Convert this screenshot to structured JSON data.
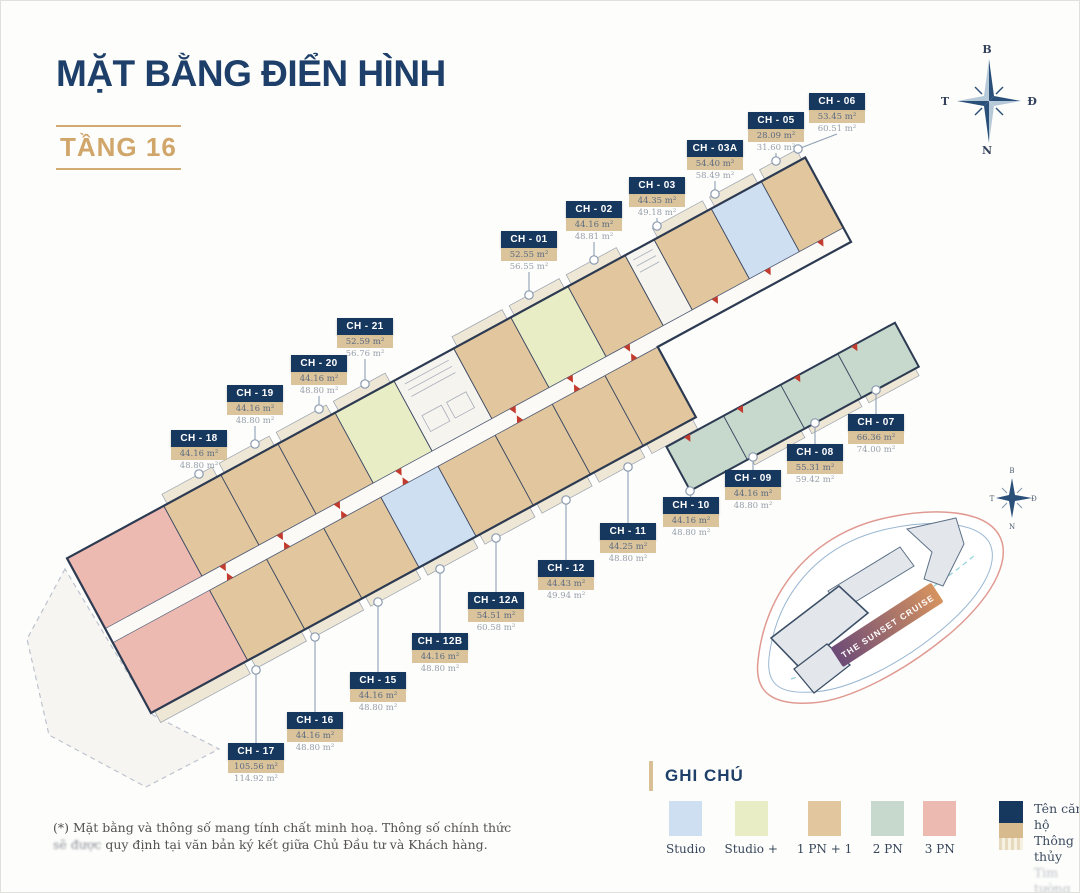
{
  "title": {
    "heading": "MẶT BẰNG ĐIỂN HÌNH",
    "floor": "TẦNG 16"
  },
  "units": [
    {
      "id": "ch-01",
      "label": "CH - 01",
      "area_net": "52.55 m²",
      "area_gross": "56.55 m²",
      "x": 500,
      "y": 230,
      "ax": 528,
      "ay": 294,
      "dir": "down"
    },
    {
      "id": "ch-02",
      "label": "CH - 02",
      "area_net": "44.16 m²",
      "area_gross": "48.81 m²",
      "x": 565,
      "y": 200,
      "ax": 593,
      "ay": 259,
      "dir": "down"
    },
    {
      "id": "ch-03",
      "label": "CH - 03",
      "area_net": "44.35 m²",
      "area_gross": "49.18 m²",
      "x": 628,
      "y": 176,
      "ax": 656,
      "ay": 225,
      "dir": "down"
    },
    {
      "id": "ch-03a",
      "label": "CH - 03A",
      "area_net": "54.40 m²",
      "area_gross": "58.49 m²",
      "x": 686,
      "y": 139,
      "ax": 714,
      "ay": 193,
      "dir": "down"
    },
    {
      "id": "ch-05",
      "label": "CH - 05",
      "area_net": "28.09 m²",
      "area_gross": "31.60 m²",
      "x": 747,
      "y": 111,
      "ax": 775,
      "ay": 160,
      "dir": "down"
    },
    {
      "id": "ch-06",
      "label": "CH - 06",
      "area_net": "53.45 m²",
      "area_gross": "60.51 m²",
      "x": 808,
      "y": 92,
      "ax": 797,
      "ay": 148,
      "dir": "down"
    },
    {
      "id": "ch-07",
      "label": "CH - 07",
      "area_net": "66.36 m²",
      "area_gross": "74.00 m²",
      "x": 847,
      "y": 413,
      "ax": 875,
      "ay": 389,
      "dir": "up"
    },
    {
      "id": "ch-08",
      "label": "CH - 08",
      "area_net": "55.31 m²",
      "area_gross": "59.42 m²",
      "x": 786,
      "y": 443,
      "ax": 814,
      "ay": 422,
      "dir": "up"
    },
    {
      "id": "ch-09",
      "label": "CH - 09",
      "area_net": "44.16 m²",
      "area_gross": "48.80 m²",
      "x": 724,
      "y": 469,
      "ax": 752,
      "ay": 456,
      "dir": "up"
    },
    {
      "id": "ch-10",
      "label": "CH - 10",
      "area_net": "44.16 m²",
      "area_gross": "48.80 m²",
      "x": 662,
      "y": 496,
      "ax": 689,
      "ay": 490,
      "dir": "up"
    },
    {
      "id": "ch-11",
      "label": "CH - 11",
      "area_net": "44.25 m²",
      "area_gross": "48.80 m²",
      "x": 599,
      "y": 522,
      "ax": 627,
      "ay": 466,
      "dir": "up"
    },
    {
      "id": "ch-12",
      "label": "CH - 12",
      "area_net": "44.43 m²",
      "area_gross": "49.94 m²",
      "x": 537,
      "y": 559,
      "ax": 565,
      "ay": 499,
      "dir": "up"
    },
    {
      "id": "ch-12a",
      "label": "CH - 12A",
      "area_net": "54.51 m²",
      "area_gross": "60.58 m²",
      "x": 467,
      "y": 591,
      "ax": 495,
      "ay": 537,
      "dir": "up"
    },
    {
      "id": "ch-12b",
      "label": "CH - 12B",
      "area_net": "44.16 m²",
      "area_gross": "48.80 m²",
      "x": 411,
      "y": 632,
      "ax": 439,
      "ay": 568,
      "dir": "up"
    },
    {
      "id": "ch-15",
      "label": "CH - 15",
      "area_net": "44.16 m²",
      "area_gross": "48.80 m²",
      "x": 349,
      "y": 671,
      "ax": 377,
      "ay": 601,
      "dir": "up"
    },
    {
      "id": "ch-16",
      "label": "CH - 16",
      "area_net": "44.16 m²",
      "area_gross": "48.80 m²",
      "x": 286,
      "y": 711,
      "ax": 314,
      "ay": 636,
      "dir": "up"
    },
    {
      "id": "ch-17",
      "label": "CH - 17",
      "area_net": "105.56 m²",
      "area_gross": "114.92 m²",
      "x": 227,
      "y": 742,
      "ax": 255,
      "ay": 669,
      "dir": "up"
    },
    {
      "id": "ch-18",
      "label": "CH - 18",
      "area_net": "44.16 m²",
      "area_gross": "48.80 m²",
      "x": 170,
      "y": 429,
      "ax": 198,
      "ay": 473,
      "dir": "down"
    },
    {
      "id": "ch-19",
      "label": "CH - 19",
      "area_net": "44.16 m²",
      "area_gross": "48.80 m²",
      "x": 226,
      "y": 384,
      "ax": 254,
      "ay": 443,
      "dir": "down"
    },
    {
      "id": "ch-20",
      "label": "CH - 20",
      "area_net": "44.16 m²",
      "area_gross": "48.80 m²",
      "x": 290,
      "y": 354,
      "ax": 318,
      "ay": 408,
      "dir": "down"
    },
    {
      "id": "ch-21",
      "label": "CH - 21",
      "area_net": "52.59 m²",
      "area_gross": "56.76 m²",
      "x": 336,
      "y": 317,
      "ax": 364,
      "ay": 383,
      "dir": "down"
    }
  ],
  "legend": {
    "heading": "GHI CHÚ",
    "types": [
      {
        "key": "studio",
        "label": "Studio",
        "color": "#cfdff2"
      },
      {
        "key": "studio_plus",
        "label": "Studio +",
        "color": "#e9edc5"
      },
      {
        "key": "pn1",
        "label": "1 PN + 1",
        "color": "#e2c79e"
      },
      {
        "key": "pn2",
        "label": "2 PN",
        "color": "#c6d9cc"
      },
      {
        "key": "pn3",
        "label": "3 PN",
        "color": "#edbab2"
      }
    ],
    "name_box": {
      "title_label": "Tên căn hộ",
      "net_label": "Thông thủy",
      "gross_label": "Tim tường",
      "title_color": "#16375e",
      "net_color": "#d7ba8d"
    }
  },
  "note": {
    "line1": "(*) Mặt bằng và thông số mang tính chất minh hoạ. Thông số chính thức",
    "line2_prefix": "sẽ được",
    "line2_rest": " quy định tại văn bản ký kết giữa Chủ Đầu tư và Khách hàng."
  },
  "compass": {
    "north": "B",
    "south": "N",
    "east": "Đ",
    "west": "T"
  },
  "site_plan": {
    "banner": "THE SUNSET CRUISE"
  }
}
